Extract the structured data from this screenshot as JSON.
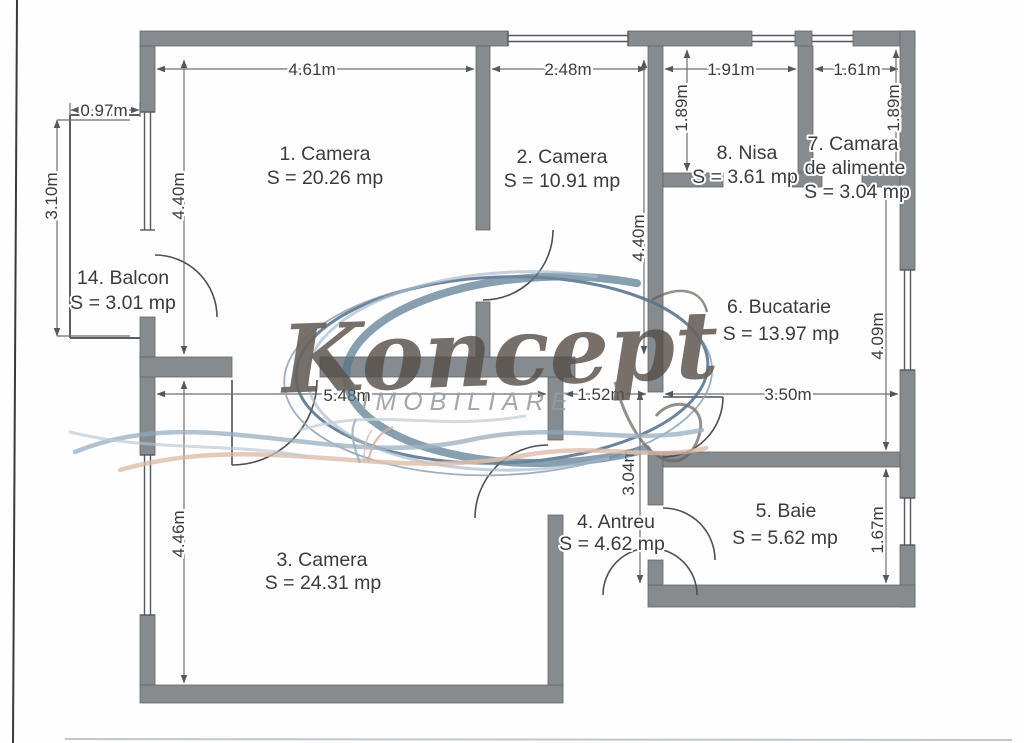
{
  "watermark": {
    "title": "Koncept",
    "subtitle": "IMOBILIARE"
  },
  "rooms": {
    "camera1": {
      "name": "1. Camera",
      "area": "S = 20.26 mp"
    },
    "camera2": {
      "name": "2. Camera",
      "area": "S = 10.91 mp"
    },
    "camera3": {
      "name": "3. Camera",
      "area": "S = 24.31 mp"
    },
    "antreu": {
      "name": "4. Antreu",
      "area": "S = 4.62 mp"
    },
    "baie": {
      "name": "5. Baie",
      "area": "S = 5.62 mp"
    },
    "bucatarie": {
      "name": "6. Bucatarie",
      "area": "S = 13.97 mp"
    },
    "camara": {
      "name": "7. Camara",
      "name2": "de alimente",
      "area": "S = 3.04 mp"
    },
    "nisa": {
      "name": "8. Nisa",
      "area": "S = 3.61 mp"
    },
    "balcon": {
      "name": "14. Balcon",
      "area": "S = 3.01 mp"
    }
  },
  "dimensions": {
    "room1_width": "4.61m",
    "room2_width": "2.48m",
    "nisa_width": "1.91m",
    "camara_width": "1.61m",
    "balcon_width": "0.97m",
    "balcon_depth": "3.10m",
    "room1_height": "4.40m",
    "room2_height": "4.40m",
    "nisa_height": "1.89m",
    "camara_height": "1.89m",
    "kitchen_height": "4.09m",
    "kitchen_width": "3.50m",
    "bath_height": "1.67m",
    "antreu_width": "1.52m",
    "antreu_height": "3.04m",
    "room3_width": "5.48m",
    "room3_height": "4.46m"
  },
  "colors": {
    "wall": "#868b8f",
    "watermark_blue": "#55788f",
    "watermark_peach": "#d9b9a3",
    "text": "#3c3c3c"
  }
}
